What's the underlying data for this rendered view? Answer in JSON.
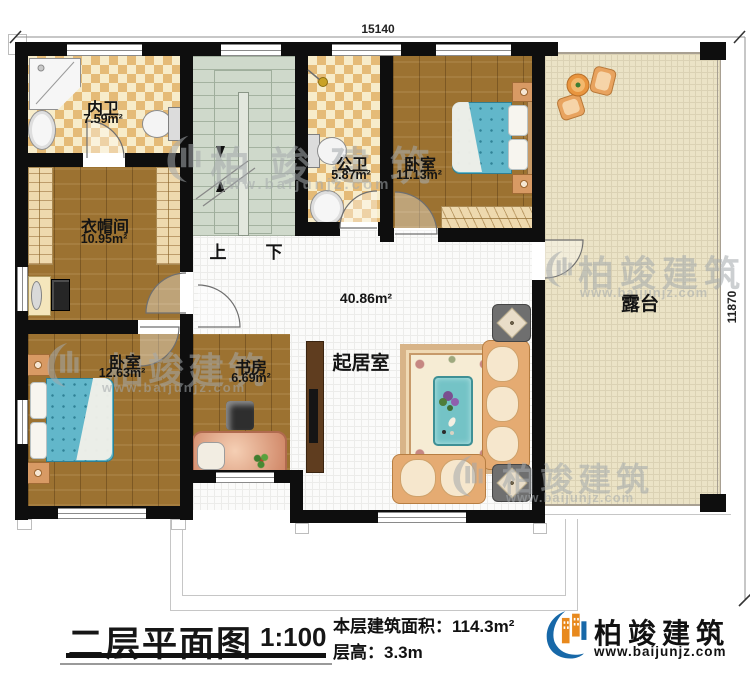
{
  "plan": {
    "dimensions": {
      "width_top": "15140",
      "height_right": "11870"
    },
    "rooms": {
      "inner_bath": {
        "name": "内卫",
        "area": "7.59m²"
      },
      "public_bath": {
        "name": "公卫",
        "area": "5.87m²"
      },
      "bedroom_top": {
        "name": "卧室",
        "area": "11.13m²"
      },
      "cloakroom": {
        "name": "衣帽间",
        "area": "10.95m²"
      },
      "bedroom_left": {
        "name": "卧室",
        "area": "12.63m²"
      },
      "study": {
        "name": "书房",
        "area": "6.69m²"
      },
      "living": {
        "name": "起居室",
        "area": "40.86m²"
      },
      "terrace": {
        "name": "露台"
      }
    },
    "stairs": {
      "up": "上",
      "down": "下"
    }
  },
  "footer": {
    "title": "二层平面图",
    "scale": "1:100",
    "floor_area": "本层建筑面积：114.3m²",
    "floor_height": "层高：3.3m"
  },
  "brand": {
    "name": "柏竣建筑",
    "website": "www.baijunjz.com"
  },
  "watermark": {
    "name": "柏竣建筑",
    "website": "www.baijunjz.com"
  }
}
